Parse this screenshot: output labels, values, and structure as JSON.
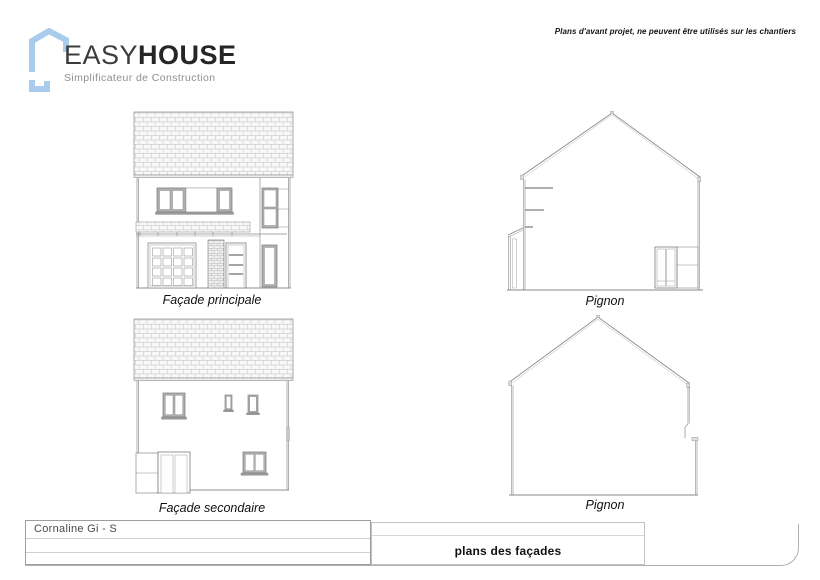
{
  "header": {
    "notice": "Plans d'avant projet, ne peuvent être utilisés sur les chantiers"
  },
  "logo": {
    "name_light": "EASY",
    "name_bold": "HOUSE",
    "tagline": "Simplificateur de Construction"
  },
  "drawings": {
    "facade_principale": {
      "label": "Façade principale"
    },
    "pignon_top": {
      "label": "Pignon"
    },
    "facade_secondaire": {
      "label": "Façade secondaire"
    },
    "pignon_bottom": {
      "label": "Pignon"
    }
  },
  "title_block": {
    "project_name": "Cornaline Gi - S",
    "sheet_title": "plans des façades"
  },
  "colors": {
    "logo_blue": "#a9cbec",
    "drawing_line": "#8a8a8a",
    "window_frame": "#b0b0b0",
    "tile_line": "#c9c9c9",
    "text_dark": "#111111"
  }
}
